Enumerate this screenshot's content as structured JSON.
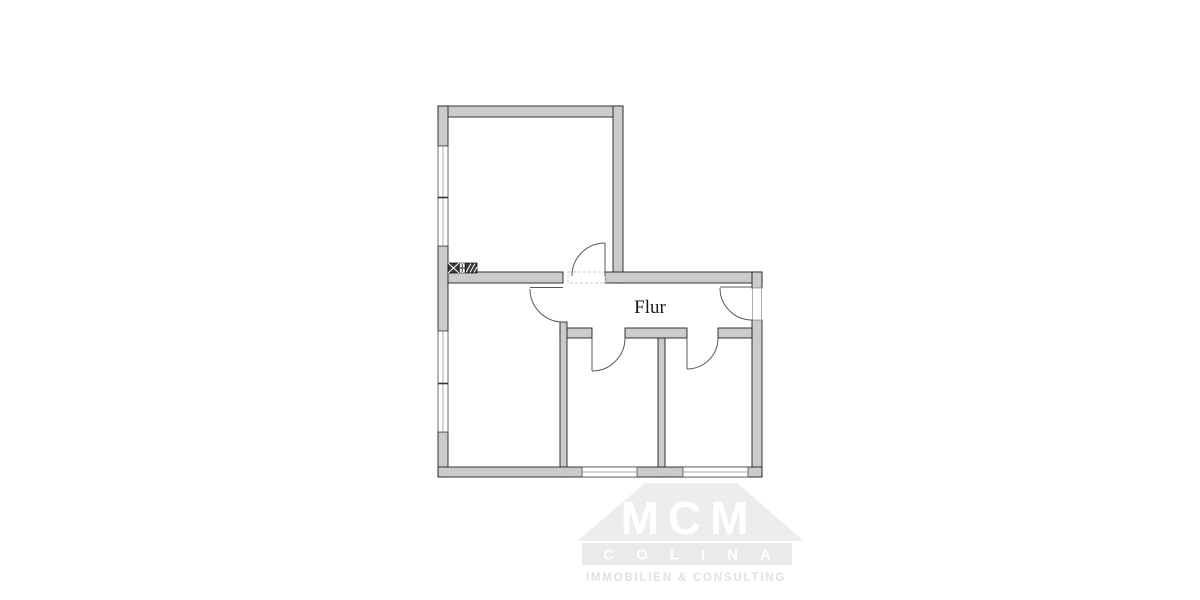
{
  "floor_plan": {
    "room_labels": {
      "hallway": "Flur"
    },
    "symbols": [
      "crossed-shaft-icon",
      "valve-icon",
      "hatched-shaft-icon"
    ],
    "colors": {
      "wall_fill": "#cbcbcb",
      "wall_outline": "#222222",
      "door_line": "#585858",
      "window_line": "#4a4a4a"
    }
  },
  "watermark": {
    "mcm": "MCM",
    "colina": "COLINA",
    "subtitle": "IMMOBILIEN & CONSULTING",
    "colors": {
      "roof": "#ededed",
      "bar": "#eaeaea",
      "letters": "#ffffff",
      "subtitle_text": "#e1e1e1"
    }
  }
}
